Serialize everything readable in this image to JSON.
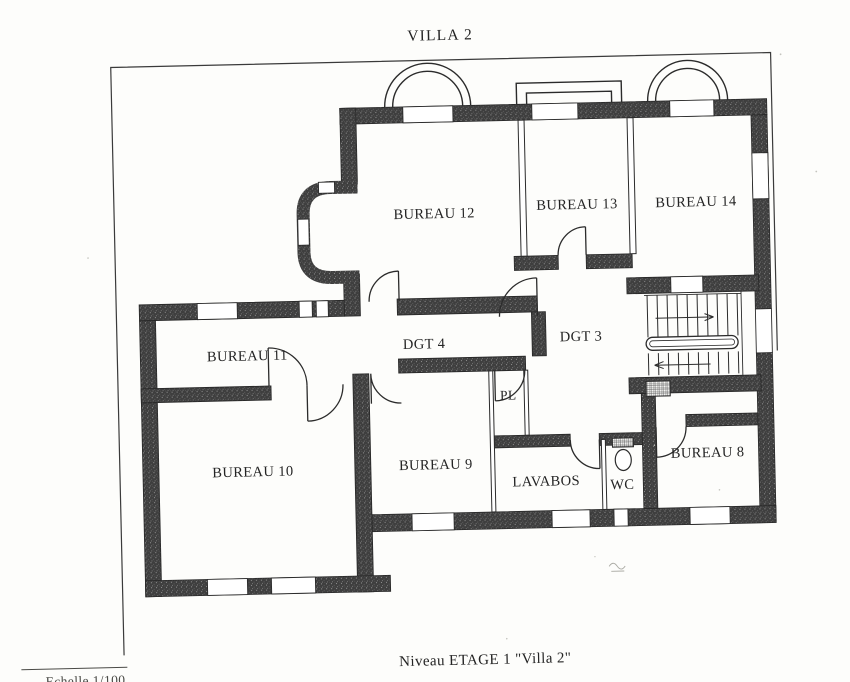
{
  "page": {
    "title": "VILLA 2",
    "caption": "Niveau ETAGE 1 \"Villa 2\"",
    "scale_label": "Echelle 1/100"
  },
  "plan": {
    "type": "floor-plan",
    "rooms": [
      {
        "id": "bureau-12",
        "label": "BUREAU 12"
      },
      {
        "id": "bureau-13",
        "label": "BUREAU 13"
      },
      {
        "id": "bureau-14",
        "label": "BUREAU 14"
      },
      {
        "id": "bureau-11",
        "label": "BUREAU 11"
      },
      {
        "id": "dgt-4",
        "label": "DGT 4"
      },
      {
        "id": "dgt-3",
        "label": "DGT 3"
      },
      {
        "id": "bureau-10",
        "label": "BUREAU 10"
      },
      {
        "id": "bureau-9",
        "label": "BUREAU 9"
      },
      {
        "id": "pl",
        "label": "PL"
      },
      {
        "id": "lavabos",
        "label": "LAVABOS"
      },
      {
        "id": "wc",
        "label": "WC"
      },
      {
        "id": "bureau-8",
        "label": "BUREAU 8"
      }
    ],
    "features": [
      "staircase-with-handrail",
      "toilet-symbol",
      "balcony",
      "two-arched-bays",
      "bow-window-bay",
      "door-swing-arcs"
    ],
    "colors": {
      "wall": "#3e3e3e",
      "line": "#2b2b2b",
      "paper": "#fdfdfb"
    }
  }
}
